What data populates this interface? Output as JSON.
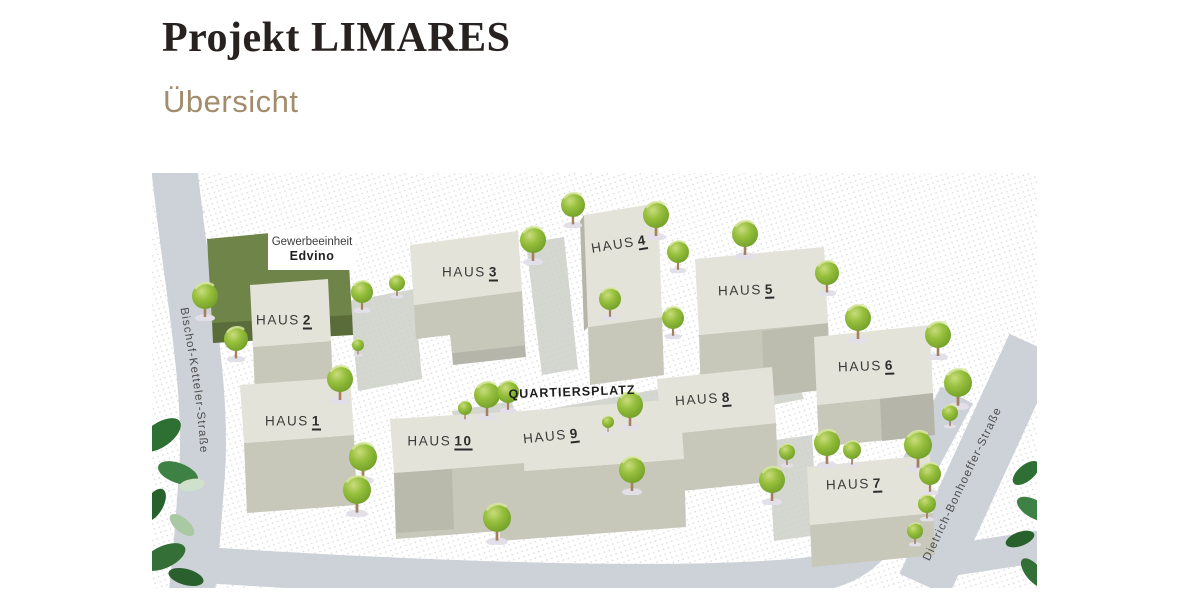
{
  "header": {
    "title": "Projekt LIMARES",
    "subtitle": "Übersicht"
  },
  "map": {
    "commercial_unit": {
      "type_label": "Gewerbeeinheit",
      "name": "Edvino"
    },
    "plaza": {
      "label": "QUARTIERSPLATZ"
    },
    "streets": {
      "left": "Bischof-Ketteler-Straße",
      "right": "Dietrich-Bonhoeffer-Straße"
    },
    "houses": [
      {
        "prefix": "HAUS",
        "number": "1"
      },
      {
        "prefix": "HAUS",
        "number": "2"
      },
      {
        "prefix": "HAUS",
        "number": "3"
      },
      {
        "prefix": "HAUS",
        "number": "4"
      },
      {
        "prefix": "HAUS",
        "number": "5"
      },
      {
        "prefix": "HAUS",
        "number": "6"
      },
      {
        "prefix": "HAUS",
        "number": "7"
      },
      {
        "prefix": "HAUS",
        "number": "8"
      },
      {
        "prefix": "HAUS",
        "number": "9"
      },
      {
        "prefix": "HAUS",
        "number": "10"
      }
    ],
    "colors": {
      "street": "#cdd2d9",
      "plaza": "#d4d6d0",
      "building_roof": "#e4e3d9",
      "building_front": "#c7c7ba",
      "building_side": "#b5b5a9",
      "commercial_roof": "#6f8449",
      "commercial_front": "#5a6c39",
      "tree_green": "#8fba37",
      "title_color": "#272220",
      "subtitle_color": "#a38c6b"
    }
  }
}
